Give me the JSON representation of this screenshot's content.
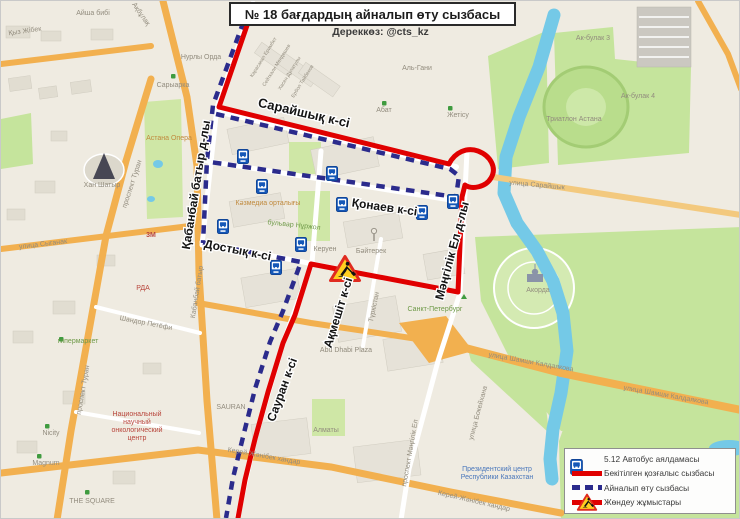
{
  "title": "№ 18 бағдардың айналып өту сызбасы",
  "source": "Дереккөз: @cts_kz",
  "colors": {
    "approved_route": "#e00000",
    "detour_route": "#2b2b8c",
    "road_orange": "#f2b04f",
    "water": "#74c9e7",
    "park_green": "#c5e49c",
    "map_background": "#efebe1",
    "roadworks_yellow": "#ffce1f",
    "bus_sign_blue": "#1558b8"
  },
  "legend": {
    "items": [
      {
        "icon": "bus-stop-sign-icon",
        "label": "5.12 Автобус аялдамасы"
      },
      {
        "icon": "approved-route-line",
        "label": "Бекітілген қозғалыс сызбасы"
      },
      {
        "icon": "detour-route-line",
        "label": "Айналып өту сызбасы"
      },
      {
        "icon": "roadworks-icon",
        "label": "Жөндеу жұмыстары"
      }
    ]
  },
  "streets": {
    "sarayshyq": "Сарайшық к-сі",
    "qonaev": "Қонаев  к-сі",
    "dostyq": "Достық  к-сі",
    "aqmeshit": "Ақмешіт к-сі",
    "sauran": "Сауран  к-сі",
    "qabanbay": "Қабанбай батыр  д-лы",
    "mangilik": "Мәңгілік Ел  д-лы"
  },
  "map_labels": {
    "nurly_orda": "Нурлы Орда",
    "saryarka": "Сарыарка",
    "astana_opera": "Астана Опера",
    "khan_shatyr": "Хан Шатыр",
    "turan": "проспект Туран",
    "syganak": "улица Сыганак",
    "gipermarket": "гипермаркет",
    "shandor": "Шандор Петёфи",
    "onko1": "Национальный",
    "onko2": "научный",
    "onko3": "онкологический",
    "onko4": "центр",
    "rda": "РДА",
    "threem": "3М",
    "nicity": "Nicity",
    "magnum": "Magnum",
    "the_square": "THE SQUARE",
    "sauran_en": "SAURAN",
    "almaty": "Алматы",
    "kazmedia": "Кәзмедиа орталығы",
    "nurzhol": "бульвар Нұржол",
    "keruen": "Керуен",
    "baiterek": "Бәйтерек",
    "turkestan": "Түркістан",
    "abu_dhabi": "Abu Dhabi Plaza",
    "sankt_peterburg": "Санкт-Петербург",
    "akorda": "Акорда",
    "ul_sarayshyq": "улица Сарайшык",
    "zhetisu": "Жетісу",
    "al_gani": "Аль-Гани",
    "abat": "Абат",
    "triatlon": "Триатлон Астана",
    "akbulak3": "Ак-булак 3",
    "akbulak4": "Ак-булак 4",
    "shamshi": "улица Шамши Калдаякова",
    "prez1": "Президентский центр",
    "prez2": "Республики Казахстан",
    "pr_mangilik": "проспект Мәңгілік Ел",
    "kerey": "Керей-Жәнібек хандар",
    "kabanbay_small": "Кабанбай батыр",
    "bokeikhana": "улица Бокейхана",
    "aisha": "Айша бибі",
    "qyz_zhibek": "Қыз Жібек",
    "aqbulaq": "Ақбұлақ",
    "d1": "Карасакал Еримбет",
    "d2": "Сейткали Мендешев",
    "d3": "Хасен Дулатулы",
    "d4": "Ербол Тайбеков"
  }
}
